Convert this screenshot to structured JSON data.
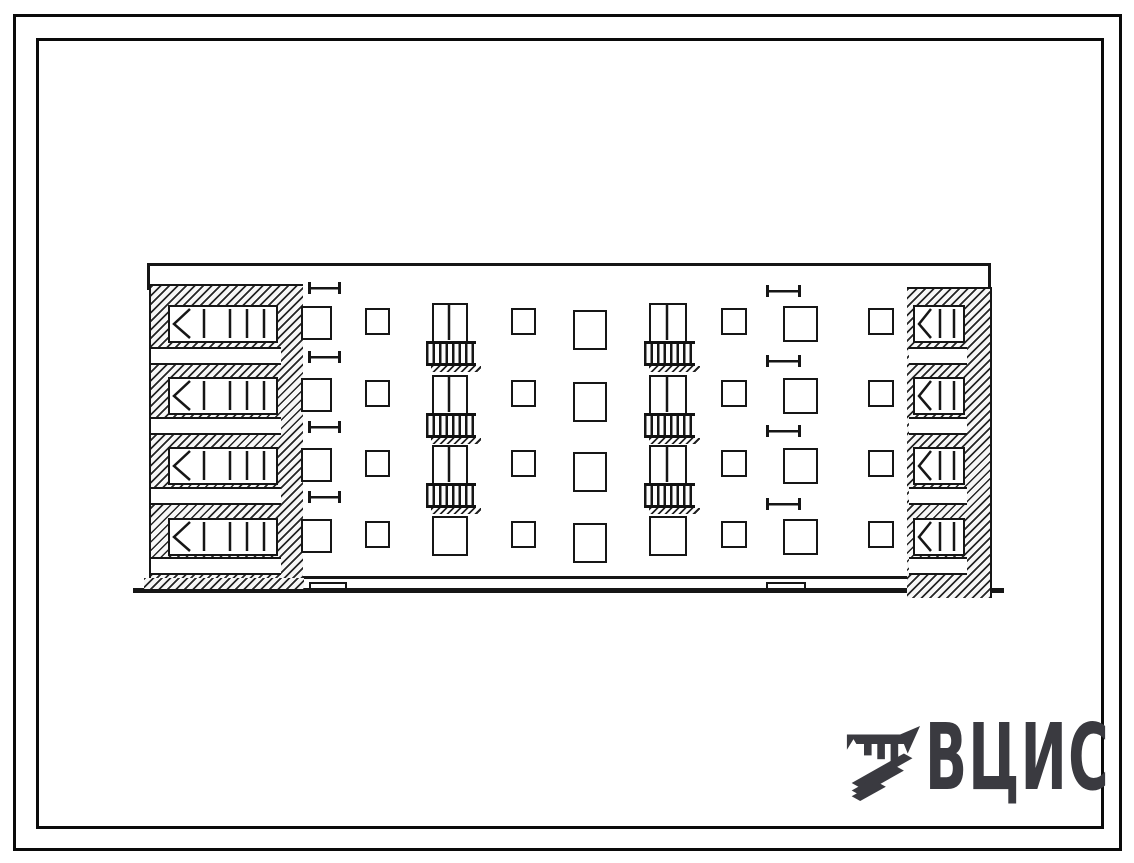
{
  "logo": {
    "text": "ВЦИС",
    "color": "#3a3a40",
    "emblem_icon": "vcis-emblem-icon"
  },
  "sheet": {
    "outer_frame": {
      "x": 13,
      "y": 14,
      "w": 1109,
      "h": 837,
      "stroke": "#0a0a0a"
    },
    "inner_frame": {
      "x": 36,
      "y": 38,
      "w": 1068,
      "h": 791,
      "stroke": "#0a0a0a"
    }
  },
  "elevation": {
    "type": "four-storey-building-front-elevation",
    "floors": 4,
    "ink": "#161616",
    "row_tops": [
      303,
      375,
      445,
      516
    ],
    "roof": {
      "x1": 147,
      "x2": 991,
      "y": 263,
      "t": 3
    },
    "edge_stubs": [
      {
        "x": 147,
        "y1": 263,
        "y2": 290
      },
      {
        "x": 988,
        "y1": 263,
        "y2": 292
      }
    ],
    "plinth": {
      "x1": 303,
      "x2": 908,
      "y": 576,
      "t": 3
    },
    "ground": {
      "x1": 133,
      "x2": 1004,
      "y": 588,
      "t": 5
    },
    "left_block": {
      "hatch": {
        "x": 149,
        "y": 284,
        "w": 154,
        "h": 294
      },
      "strips": {
        "x": 151,
        "w": 130,
        "h": 18,
        "ys": [
          347,
          417,
          487,
          557
        ]
      },
      "windows": {
        "x": 168,
        "w": 110,
        "h": 38,
        "dy": 2,
        "chamfer": 20,
        "mullions": [
          34,
          60,
          77,
          94
        ]
      },
      "base": {
        "x": 144,
        "y": 578,
        "w": 160,
        "h": 13
      }
    },
    "right_block": {
      "hatch": {
        "x": 907,
        "y": 287,
        "w": 85,
        "h": 311
      },
      "strips": {
        "x": 909,
        "w": 58,
        "h": 18,
        "ys": [
          347,
          417,
          487,
          557
        ]
      },
      "windows": {
        "x": 913,
        "w": 52,
        "h": 38,
        "dy": 2,
        "chamfer": 16,
        "mullions": [
          25,
          39
        ]
      }
    },
    "columns": [
      {
        "kind": "stair",
        "x": 301,
        "w": 31,
        "h": 34,
        "dy": 3
      },
      {
        "kind": "small",
        "x": 365,
        "w": 25,
        "h": 27,
        "dy": 5
      },
      {
        "kind": "balcony",
        "x": 432,
        "w": 36,
        "h": 40,
        "dy": 0,
        "mullion": 15,
        "rail": {
          "x": 426,
          "w": 50,
          "h": 25
        }
      },
      {
        "kind": "small",
        "x": 511,
        "w": 25,
        "h": 27,
        "dy": 5
      },
      {
        "kind": "large",
        "x": 573,
        "w": 34,
        "h": 40,
        "dy": 7
      },
      {
        "kind": "balcony",
        "x": 649,
        "w": 38,
        "h": 40,
        "dy": 0,
        "mullion": 16,
        "rail": {
          "x": 644,
          "w": 51,
          "h": 25
        }
      },
      {
        "kind": "small",
        "x": 721,
        "w": 26,
        "h": 27,
        "dy": 5
      },
      {
        "kind": "stair",
        "x": 783,
        "w": 35,
        "h": 36,
        "dy": 3
      },
      {
        "kind": "small",
        "x": 868,
        "w": 26,
        "h": 27,
        "dy": 5
      }
    ],
    "stair_marks": [
      {
        "x": 308,
        "w": 33,
        "h": 12,
        "ys": [
          282,
          351,
          421,
          491
        ]
      },
      {
        "x": 766,
        "w": 35,
        "h": 12,
        "ys": [
          285,
          355,
          425,
          498
        ]
      }
    ],
    "entrance_steps": [
      {
        "x": 309,
        "y": 582,
        "w": 38,
        "h": 8
      },
      {
        "x": 766,
        "y": 582,
        "w": 40,
        "h": 8
      }
    ]
  }
}
